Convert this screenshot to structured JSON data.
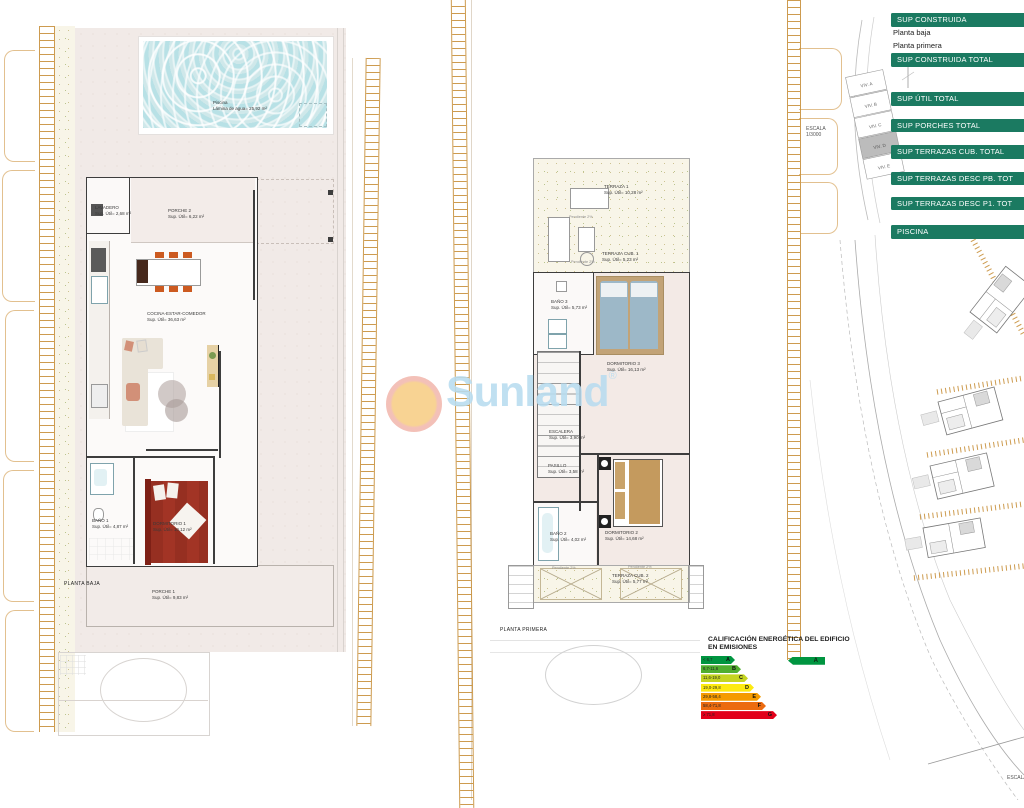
{
  "colors": {
    "accent": "#1b7a61",
    "ladder": "#c8913c"
  },
  "watermark": {
    "brand": "Sunland",
    "registered": "®"
  },
  "scale_note": {
    "label": "ESCALA",
    "value": "1/3000"
  },
  "bottom_scale_label": "ESCALA",
  "north_label": "N",
  "key_plan": {
    "units": [
      "VIV. A",
      "VIV. B",
      "VIV. C",
      "VIV. D",
      "VIV. E"
    ],
    "highlighted": "VIV. D"
  },
  "summary_table": {
    "rows": [
      {
        "label": "SUP CONSTRUIDA",
        "type": "header"
      },
      {
        "label": "Planta baja",
        "type": "row"
      },
      {
        "label": "Planta primera",
        "type": "row"
      },
      {
        "label": "SUP CONSTRUIDA TOTAL",
        "type": "header"
      },
      {
        "label": "SUP ÚTIL TOTAL",
        "type": "header"
      },
      {
        "label": "SUP PORCHES TOTAL",
        "type": "header"
      },
      {
        "label": "SUP TERRAZAS CUB. TOTAL",
        "type": "header"
      },
      {
        "label": "SUP TERRAZAS DESC PB. TOT",
        "type": "header"
      },
      {
        "label": "SUP TERRAZAS DESC P1. TOT",
        "type": "header"
      },
      {
        "label": "PISCINA",
        "type": "header"
      }
    ]
  },
  "plans": {
    "ground": {
      "title": "PLANTA BAJA",
      "pool": {
        "name": "Piscina",
        "detail": "Lámina de agua= 25,92 m²"
      },
      "rooms": [
        {
          "name": "LAVADERO",
          "area": "Sup. Útil= 2,68 m²"
        },
        {
          "name": "PORCHE 2",
          "area": "Sup. Útil= 6,22 m²"
        },
        {
          "name": "COCINA-ESTAR-COMEDOR",
          "area": "Sup. Útil= 36,63 m²"
        },
        {
          "name": "BAÑO 1",
          "area": "Sup. Útil= 4,87 m²"
        },
        {
          "name": "DORMITORIO 1",
          "area": "Sup. Útil= 10,12 m²"
        },
        {
          "name": "PORCHE 1",
          "area": "Sup. Útil= 9,83 m²"
        }
      ]
    },
    "first": {
      "title": "PLANTA PRIMERA",
      "rooms": [
        {
          "name": "TERRAZA 1",
          "area": "Sup. Útil= 10,28 m²"
        },
        {
          "name": "TERRAZA CUB. 1",
          "area": "Sup. Útil= 5,23 m²"
        },
        {
          "name": "BAÑO 3",
          "area": "Sup. Útil= 5,73 m²"
        },
        {
          "name": "DORMITORIO 3",
          "area": "Sup. Útil= 16,13 m²"
        },
        {
          "name": "ESCALERA",
          "area": "Sup. Útil= 3,90 m²"
        },
        {
          "name": "PASILLO",
          "area": "Sup. Útil= 3,58 m²"
        },
        {
          "name": "BAÑO 2",
          "area": "Sup. Útil= 4,02 m²"
        },
        {
          "name": "DORMITORIO 2",
          "area": "Sup. Útil= 14,68 m²"
        },
        {
          "name": "TERRAZA CUB. 2",
          "area": "Sup. Útil= 5,77 m²"
        }
      ],
      "notes": [
        "Pendiente 2%",
        "Pendiente 2%",
        "Pendiente 2%",
        "Pendiente 2%"
      ]
    }
  },
  "energy_label": {
    "title_line1": "CALIFICACIÓN ENERGÉTICA DEL EDIFICIO",
    "title_line2": "EN EMISIONES",
    "scale": [
      {
        "range": "< 6,7",
        "letter": "A",
        "color": "#009540",
        "width": 34
      },
      {
        "range": "6,7-11,6",
        "letter": "B",
        "color": "#50ae2f",
        "width": 40
      },
      {
        "range": "11,6-19,0",
        "letter": "C",
        "color": "#c5d421",
        "width": 47
      },
      {
        "range": "19,0-29,8",
        "letter": "D",
        "color": "#fdea11",
        "width": 53
      },
      {
        "range": "29,8-58,4",
        "letter": "E",
        "color": "#f59b00",
        "width": 60
      },
      {
        "range": "58,4-71,8",
        "letter": "F",
        "color": "#ec6b10",
        "width": 65
      },
      {
        "range": "≥ 71,8",
        "letter": "G",
        "color": "#e2001a",
        "width": 76
      }
    ],
    "rating": {
      "letter": "A",
      "color": "#009540"
    }
  }
}
